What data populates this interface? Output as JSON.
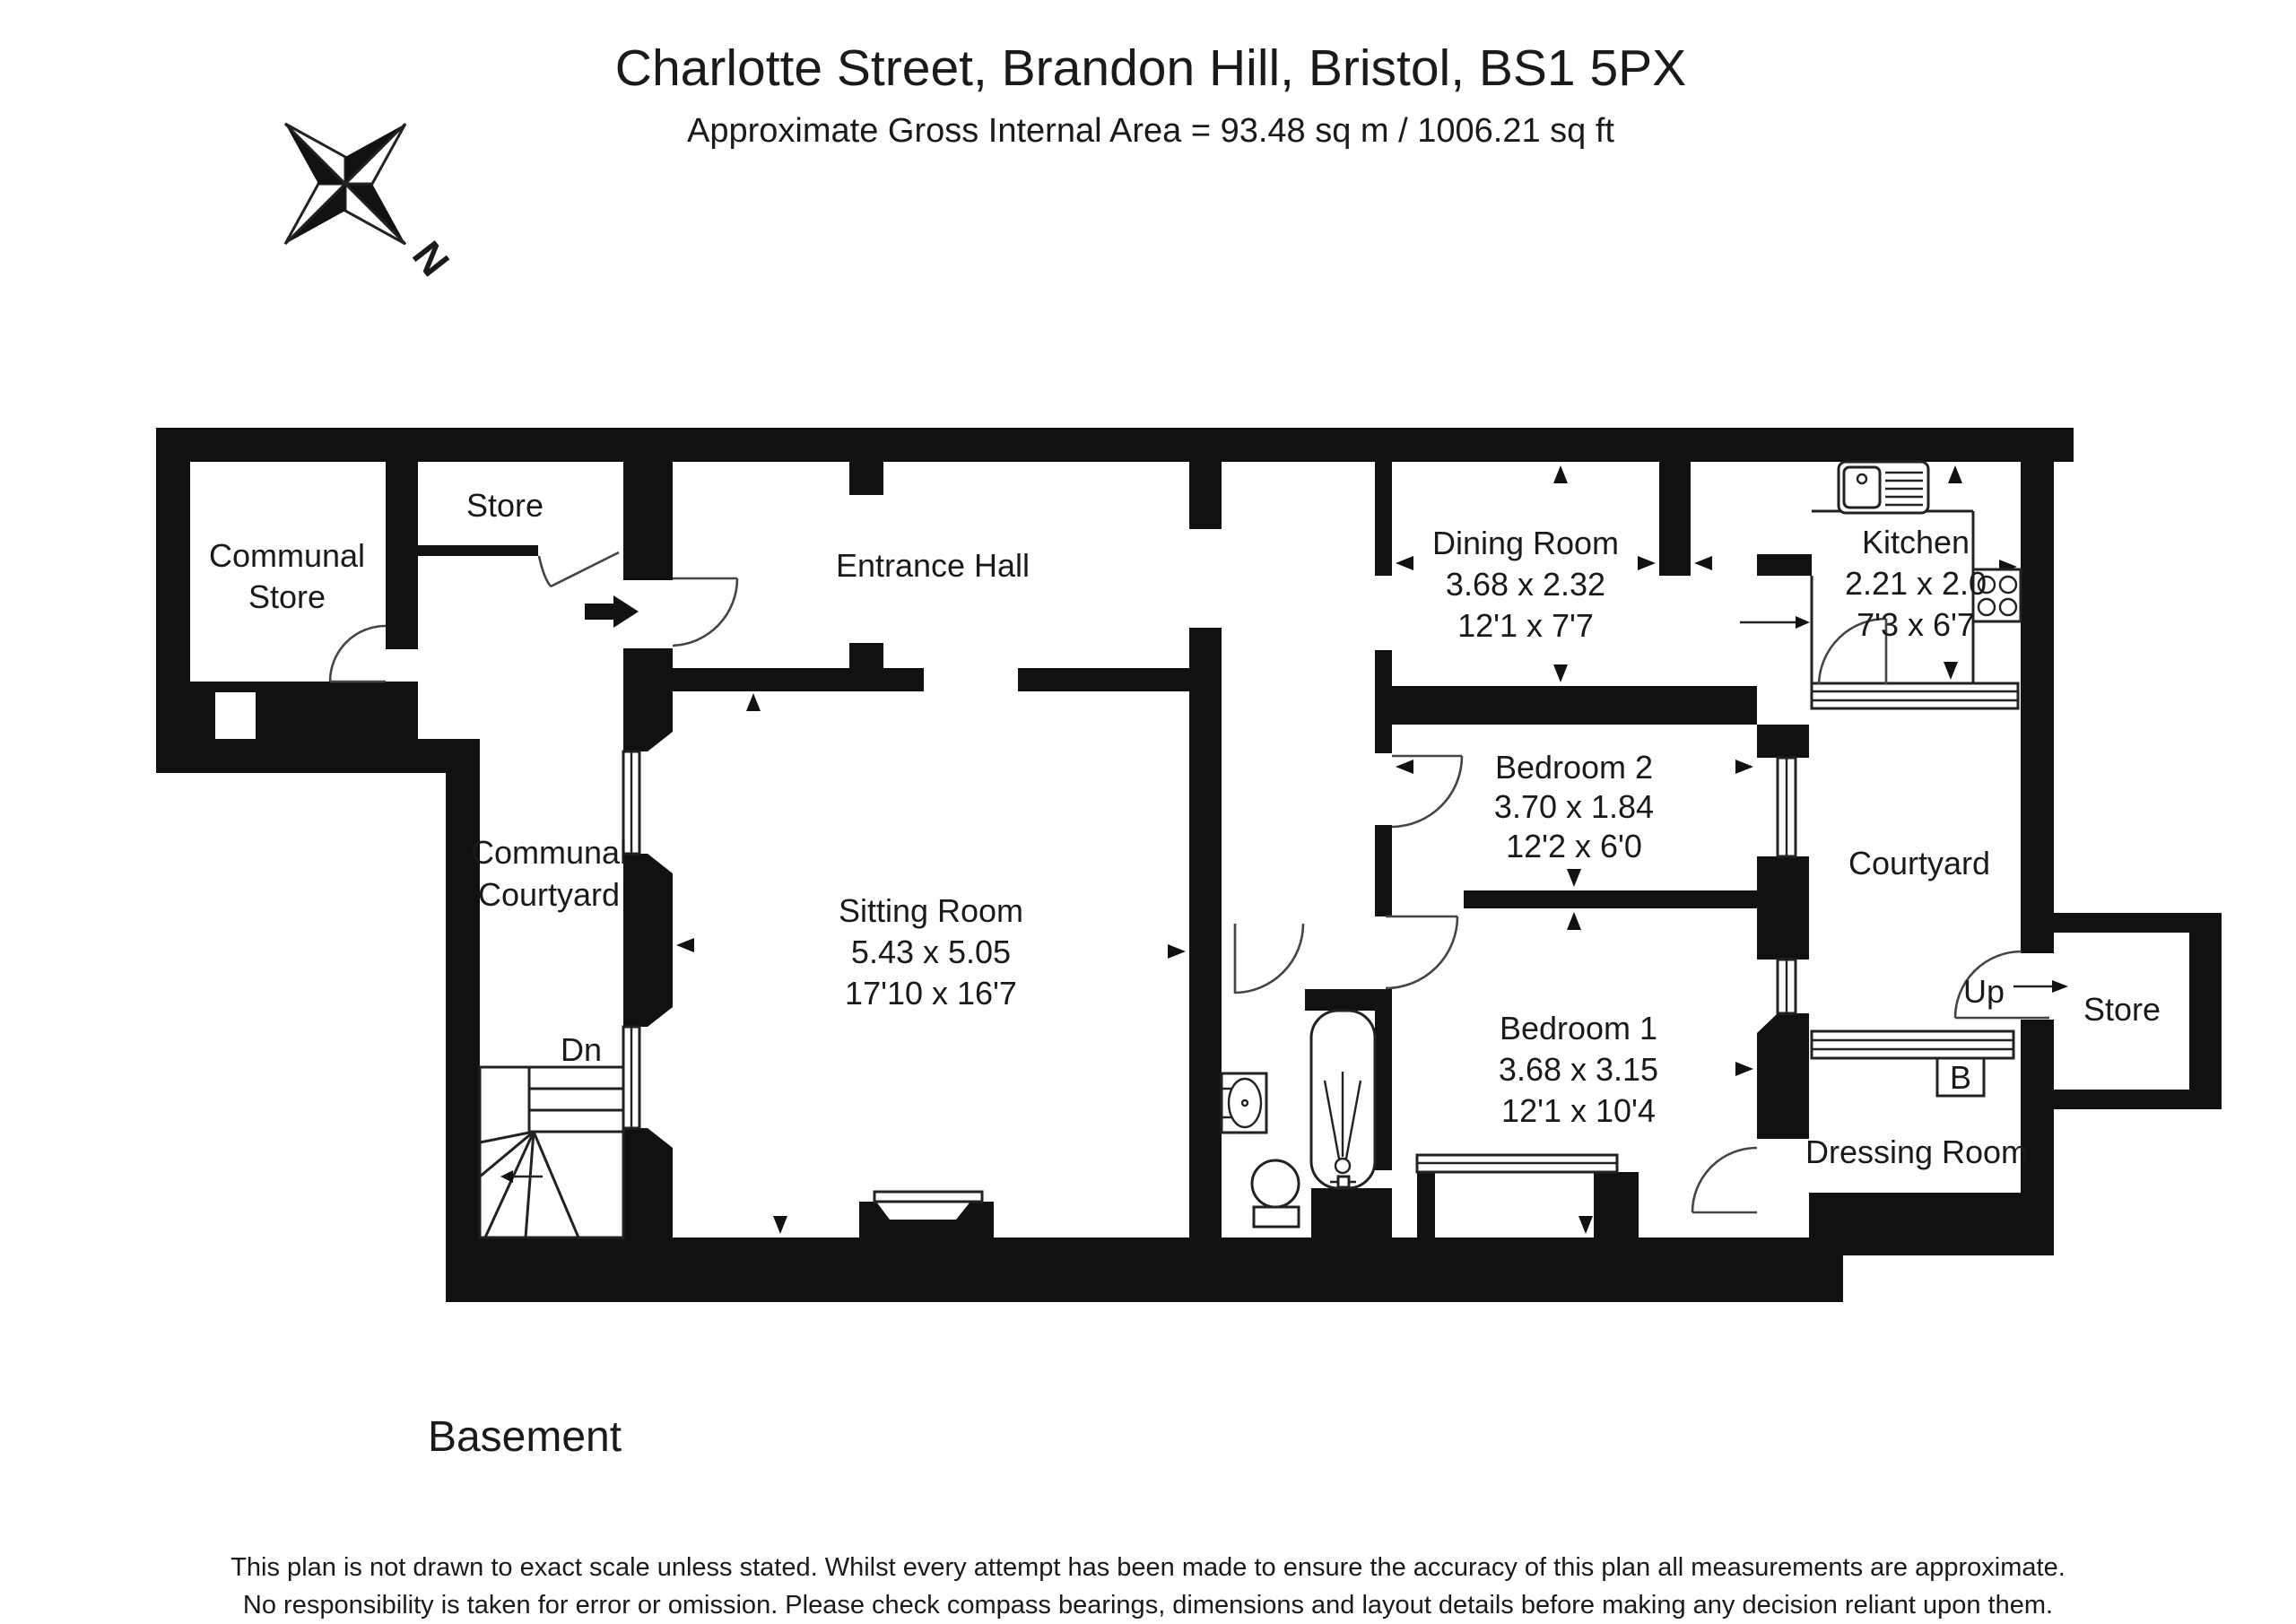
{
  "header": {
    "title": "Charlotte Street, Brandon Hill, Bristol, BS1 5PX",
    "subtitle": "Approximate Gross Internal Area = 93.48 sq m / 1006.21 sq ft"
  },
  "compass": {
    "north_label": "N"
  },
  "floor_label": "Basement",
  "disclaimer": {
    "line1": "This plan is not drawn to exact scale unless stated.  Whilst every attempt has been made to ensure the accuracy of this plan all measurements are approximate.",
    "line2": "No responsibility is taken for error or omission.  Please check compass bearings, dimensions and layout details before making any decision reliant upon them."
  },
  "rooms": {
    "communal_store": {
      "name_line1": "Communal",
      "name_line2": "Store"
    },
    "store_left": {
      "name": "Store"
    },
    "entrance_hall": {
      "name": "Entrance Hall"
    },
    "sitting_room": {
      "name": "Sitting Room",
      "metric": "5.43 x 5.05",
      "imperial": "17'10 x 16'7"
    },
    "communal_courtyard": {
      "name_line1": "Communal",
      "name_line2": "Courtyard"
    },
    "dining_room": {
      "name": "Dining Room",
      "metric": "3.68 x 2.32",
      "imperial": "12'1 x 7'7"
    },
    "kitchen": {
      "name": "Kitchen",
      "metric": "2.21 x 2.0",
      "imperial": "7'3 x 6'7"
    },
    "bedroom_2": {
      "name": "Bedroom 2",
      "metric": "3.70 x 1.84",
      "imperial": "12'2 x 6'0"
    },
    "bedroom_1": {
      "name": "Bedroom 1",
      "metric": "3.68 x 3.15",
      "imperial": "12'1 x 10'4"
    },
    "courtyard": {
      "name": "Courtyard"
    },
    "dressing_room": {
      "name": "Dressing Room"
    },
    "store_right": {
      "name": "Store"
    },
    "stairs_down_label": "Dn",
    "stairs_up_label": "Up",
    "boiler_label": "B"
  },
  "colors": {
    "wall": "#111111",
    "line": "#222222",
    "background": "#ffffff",
    "text": "#1a1a1a"
  }
}
